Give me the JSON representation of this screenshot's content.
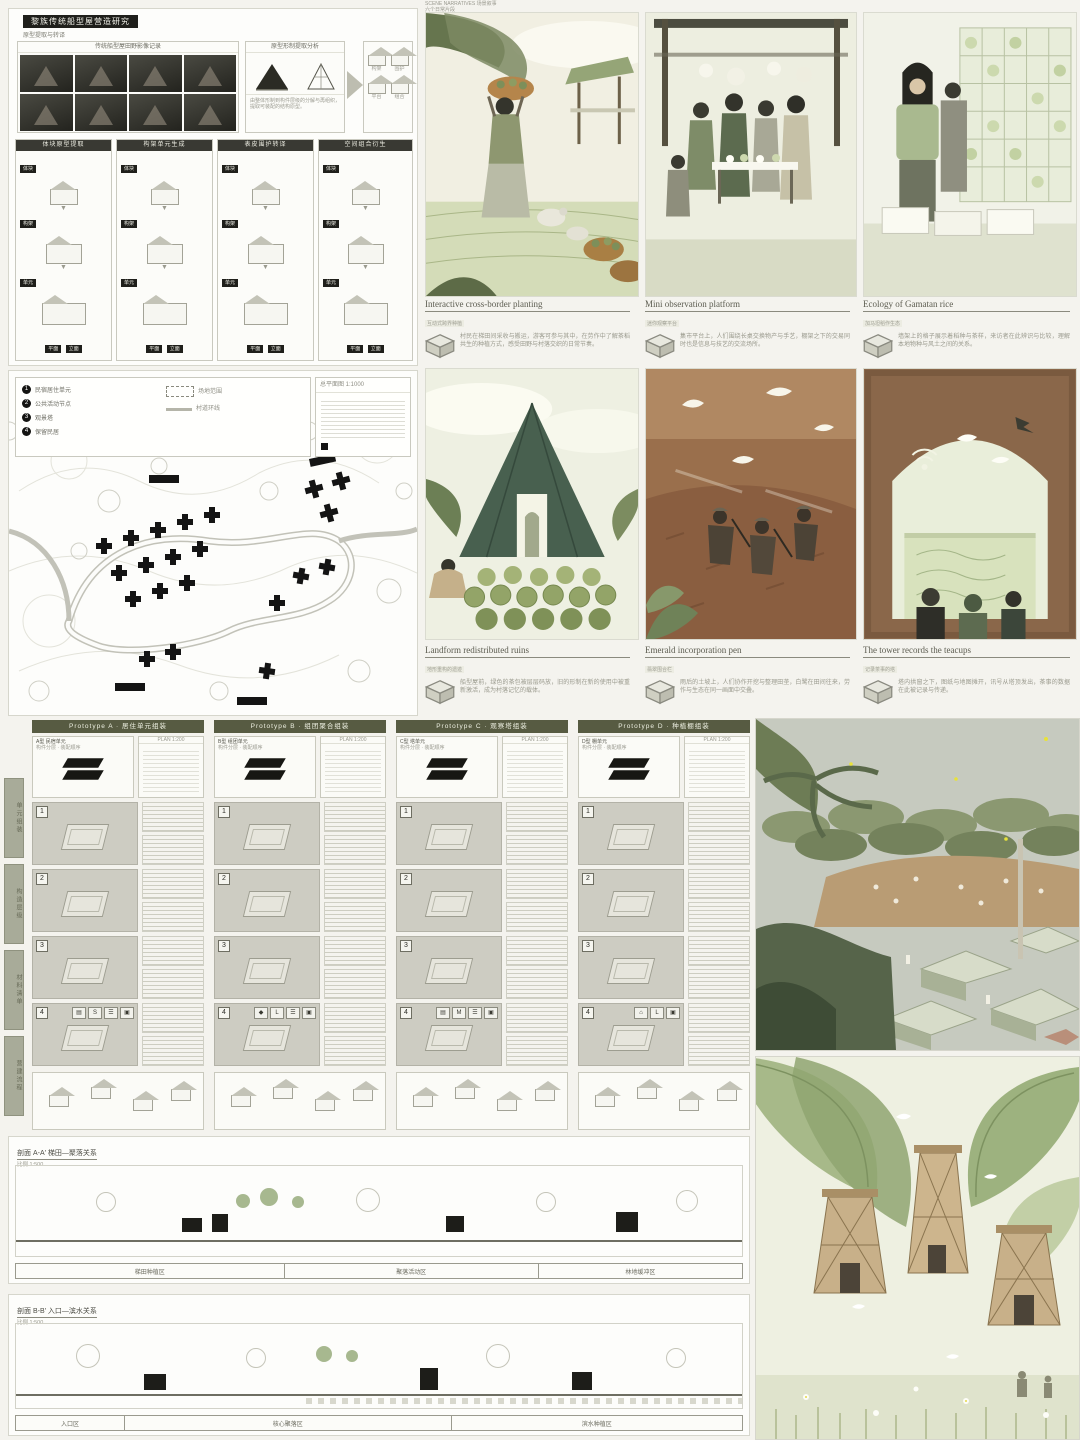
{
  "research": {
    "title": "黎族传统船型屋营造研究",
    "subtitle": "原型提取与转译",
    "photos_header": "传统船型屋田野影像记录",
    "form_header": "原型形制提取分析",
    "form_note": "由整体形制到构件层级的分解与再组织，提取可装配的结构原型。",
    "sketch_labels": [
      "构架",
      "围护",
      "平台",
      "组合"
    ],
    "column_headers": [
      "体块原型提取",
      "构架单元生成",
      "表皮围护转译",
      "空间组合衍生"
    ],
    "cell_chips": [
      "体块",
      "构架",
      "单元"
    ],
    "bottom_chips": [
      "平面",
      "立面"
    ]
  },
  "illustrations": {
    "header": "SCENE NARRATIVES 场景叙事",
    "header_sub": "六个日常片段",
    "panels": [
      {
        "title": "Interactive cross-border planting",
        "sub": "互动式跨界种植",
        "desc": "村民在梯田间采收与搬运，游客可参与其中，在劳作中了解茶稻共生的种植方式，感受田野与村落交织的日常节奏。"
      },
      {
        "title": "Mini observation platform",
        "sub": "迷你观察平台",
        "desc": "集市平台上，人们围绕长桌交换物产与手艺，棚架之下的交易同时也是信息与技艺的交流场所。"
      },
      {
        "title": "Ecology of Gamatan rice",
        "sub": "加马坦稻作生态",
        "desc": "墙架上的格子展示着稻种与茶样，来访者在此辨识与比较，理解本地物种与风土之间的关系。"
      },
      {
        "title": "Landform redistributed ruins",
        "sub": "地形重构的遗迹",
        "desc": "船型屋前，绿色的茶包被层层码放，旧的形制在新的使用中被重新激活，成为村落记忆的载体。"
      },
      {
        "title": "Emerald incorporation pen",
        "sub": "翡翠围合栏",
        "desc": "雨后的土坡上，人们协作开挖与整理田垄，白鹭在田间往来，劳作与生态在同一画面中交叠。"
      },
      {
        "title": "The tower records the teacups",
        "sub": "记录茶事的塔",
        "desc": "塔内拱窗之下，图纸与地图摊开，讯号从塔顶发出，茶事的数据在此被记录与传递。"
      }
    ]
  },
  "site_plan": {
    "legend": [
      {
        "num": "1",
        "label": "民宿居住单元"
      },
      {
        "num": "2",
        "label": "公共活动节点"
      },
      {
        "num": "3",
        "label": "观景塔"
      },
      {
        "num": "4",
        "label": "保留民居"
      }
    ],
    "boundary_label": "场地范围",
    "road_label": "村道环线",
    "note_title": "总平面图 1:1000"
  },
  "assembly": {
    "side_index": [
      "单元组装",
      "构造层级",
      "材料清单",
      "营建流程"
    ],
    "step_numbers": [
      "1",
      "2",
      "3",
      "4"
    ],
    "plan_label": "PLAN 1:200",
    "columns": [
      {
        "header": "Prototype A · 居住单元组装",
        "type_name": "A型 民宿单元",
        "type_note": "构件分层 · 装配顺序",
        "size": "S"
      },
      {
        "header": "Prototype B · 组团聚合组装",
        "type_name": "B型 组团单元",
        "type_note": "构件分层 · 装配顺序",
        "size": "L"
      },
      {
        "header": "Prototype C · 观察塔组装",
        "type_name": "C型 塔单元",
        "type_note": "构件分层 · 装配顺序",
        "size": "M"
      },
      {
        "header": "Prototype D · 种植棚组装",
        "type_name": "D型 棚单元",
        "type_note": "构件分层 · 装配顺序",
        "size": "L"
      }
    ]
  },
  "sections": [
    {
      "title": "剖面 A-A′ 梯田—聚落关系",
      "sub": "比例 1:500",
      "segments": [
        "梯田种植区",
        "聚落活动区",
        "林地缓冲区"
      ]
    },
    {
      "title": "剖面 B-B′ 入口—滨水关系",
      "sub": "比例 1:500",
      "segments": [
        "入口区",
        "核心聚落区",
        "滨水种植区"
      ]
    }
  ]
}
